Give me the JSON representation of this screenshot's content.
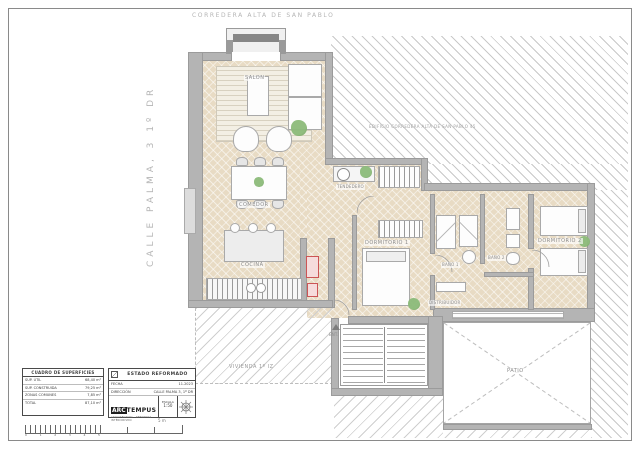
{
  "sheet": {
    "street_top": "CORREDERA ALTA DE SAN PABLO",
    "street_left": "CALLE PALMA, 3 1º DR",
    "neighbor_building_label": "EDIFICIO CORREDERA ALTA DE SAN PABLO 45",
    "neighbor_flat_label": "VIVIENDA 1º IZ"
  },
  "rooms": {
    "salon": "SALON",
    "comedor": "COMEDOR",
    "cocina": "COCINA",
    "tendedero": "TENDEDERO",
    "dormitorio1": "DORMITORIO 1",
    "bano1": "BAÑO 1",
    "bano2": "BAÑO 2",
    "dormitorio2": "DORMITORIO 2",
    "patio": "PATIO",
    "distribuidor": "DISTRIBUIDOR",
    "entrada": "ENT."
  },
  "surfaces_table": {
    "header": "CUADRO DE SUPERFICIES",
    "rows": [
      {
        "label": "SUP. ÚTIL",
        "value": "68,40 m²"
      },
      {
        "label": "SUP. CONSTRUIDA",
        "value": "79,25 m²"
      },
      {
        "label": "ZONAS COMUNES",
        "value": "7,85 m²"
      },
      {
        "label": "TOTAL",
        "value": "87,10 m²"
      }
    ]
  },
  "project_block": {
    "state": "ESTADO REFORMADO",
    "date_label": "FECHA",
    "date_value": "11.2023",
    "address_label": "DIRECCIÓN",
    "address_value": "CALLE PALMA 3, 1º DR",
    "logo_prefix": "ARC",
    "logo_suffix": "TEMPUS",
    "logo_tagline": "ARQUITECTURA · REFORMAS · INTERIORISMO",
    "scale_label": "ESCALA",
    "scale_value": "1:50"
  },
  "scale_bar": {
    "numbers": [
      "0",
      "1",
      "2",
      "3",
      "4",
      "5"
    ],
    "unit_label": "5 m"
  },
  "colors": {
    "floor_beige": "#e8dbc4",
    "wall_gray": "#b4b4b4",
    "hatch_gray": "#c9c9c9",
    "plant_green": "#7fae6f",
    "alert_red": "#cc5555",
    "label_gray": "#8c8c8c"
  }
}
